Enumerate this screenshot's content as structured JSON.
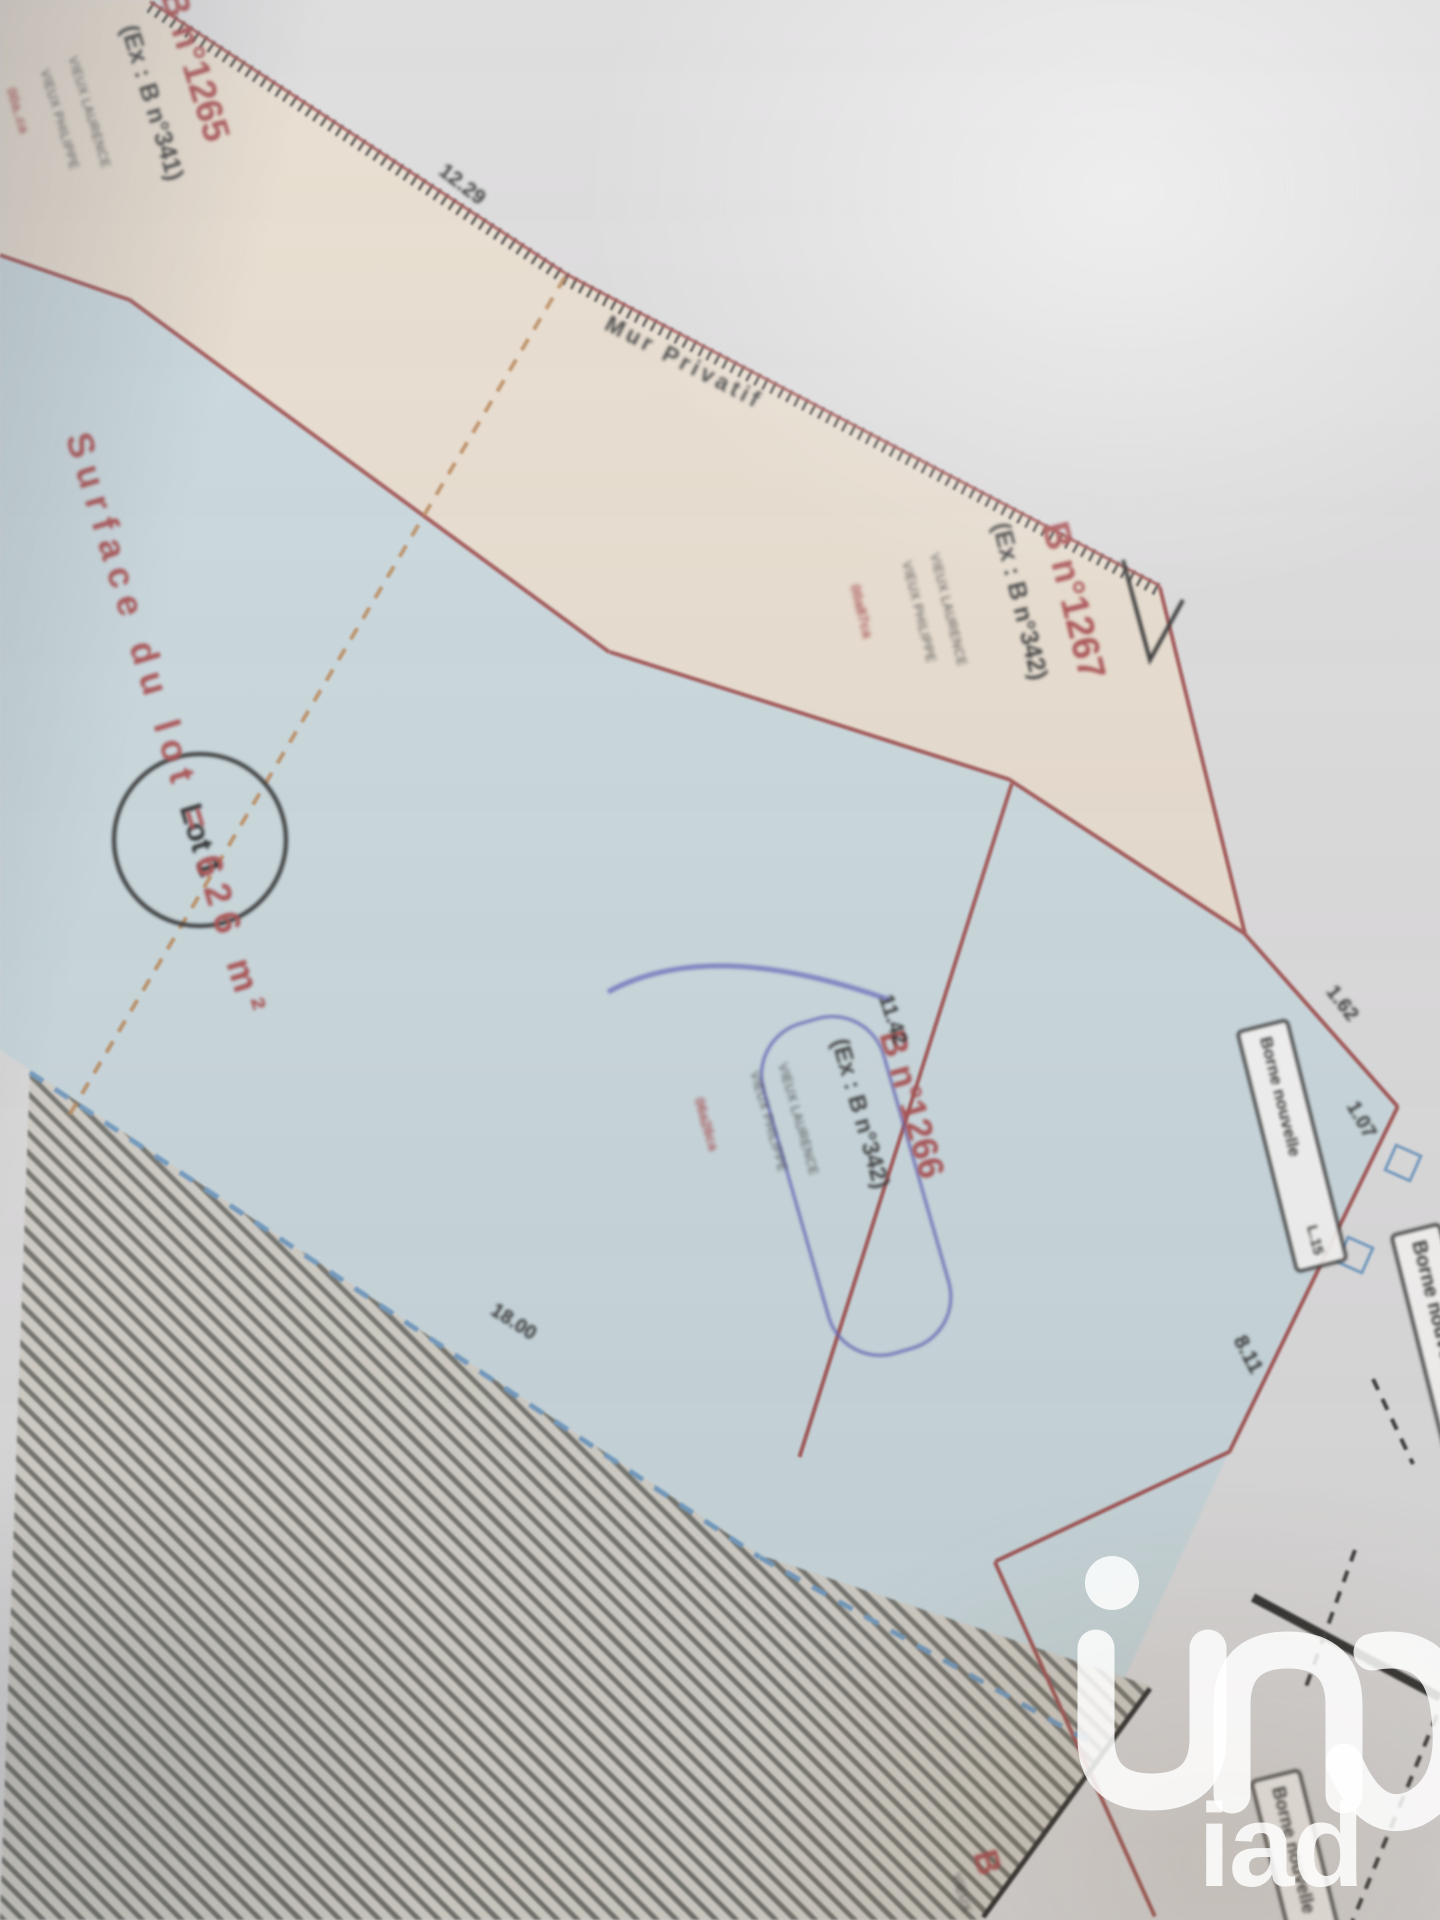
{
  "plan": {
    "lot": {
      "badge": "Lot 1",
      "surface_label": "Surface du lot = 626 m²"
    },
    "wall_label": "Mur Privatif",
    "parcels": {
      "b1265": {
        "name": "B n°1265",
        "former": "(Ex : B n°341)",
        "owner1": "VIEUX LAURENCE",
        "owner2": "VIEUX PHILIPPE",
        "surface": "00a..ca"
      },
      "b1267": {
        "name": "B n°1267",
        "former": "(Ex : B n°342)",
        "owner1": "VIEUX LAURENCE",
        "owner2": "VIEUX PHILIPPE",
        "surface": "00a87ca"
      },
      "b1266": {
        "name": "B n°1266",
        "former": "(Ex : B n°342)",
        "owner1": "VIEUX LAURENCE",
        "owner2": "VIEUX PHILIPPE",
        "surface": "06a26ca"
      },
      "b_bottom": {
        "name": "B",
        "owner": "VIEUX"
      }
    },
    "bornes": {
      "l15_point": "L.15",
      "l15_label": "Borne nouvelle",
      "right_label": "Borne nouvelle",
      "bottom_label": "Borne nouvelle"
    },
    "measurements": {
      "top": "12.29",
      "seg_162": "1.62",
      "seg_107": "1.07",
      "seg_811": "8.11",
      "seg_1142": "11.42",
      "seg_1800": "18.00"
    }
  },
  "watermark": {
    "brand": "iad"
  },
  "colors": {
    "parcel_blue": "#cadbe1",
    "parcel_beige": "#ebdfcf",
    "boundary_red": "#a85454",
    "cadastre_red": "#b04a4c",
    "ink": "#3b3b3b",
    "pen_blue": "#6265bd",
    "dash_orange": "#c08a58",
    "dash_blue": "#6f9cc6",
    "paper": "#dcdbdc"
  }
}
